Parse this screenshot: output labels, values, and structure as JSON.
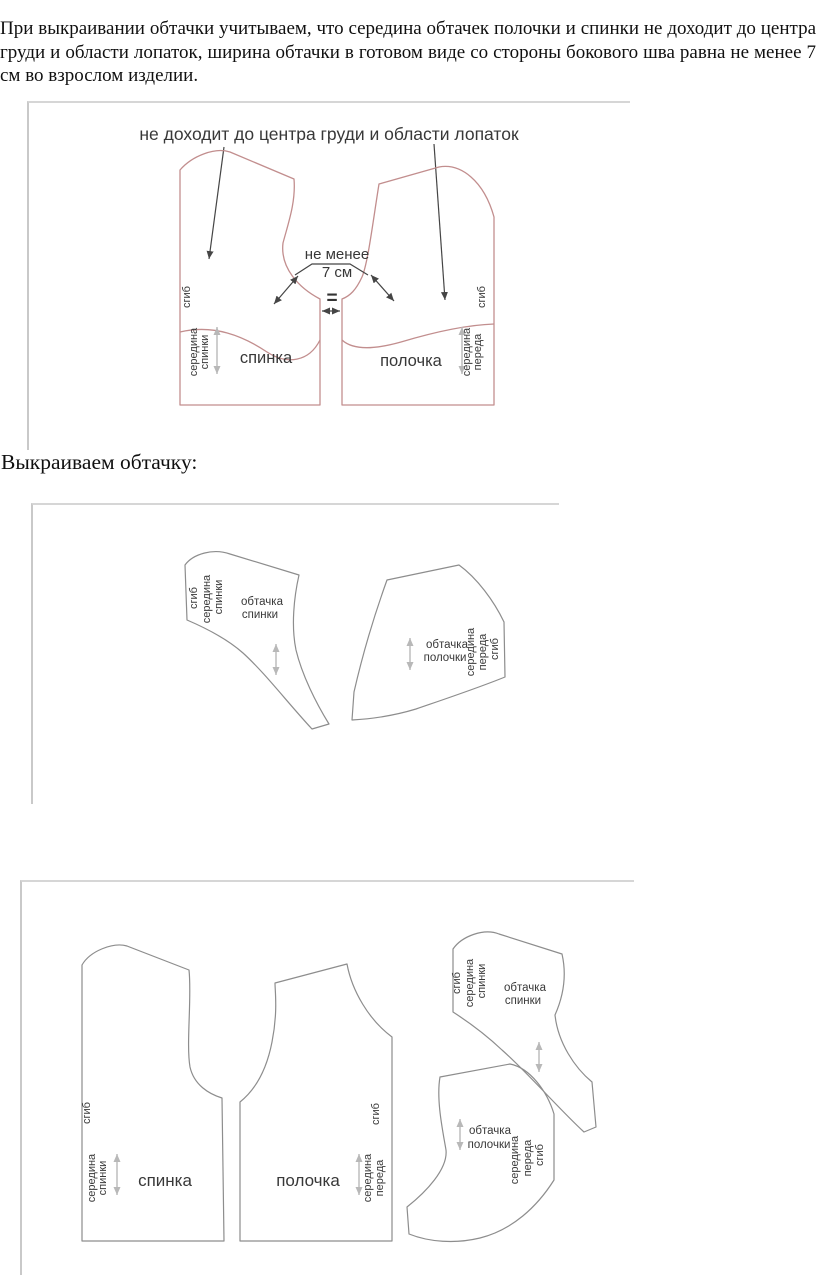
{
  "document": {
    "intro_paragraph": "При выкраивании обтачки учитываем, что середина обтачек полочки и спинки не доходит до центра груди и области лопаток, ширина обтачки в готовом виде со стороны бокового шва равна не менее 7 см во взрослом изделии.",
    "section_heading": "Выкраиваем обтачку:"
  },
  "figure1": {
    "caption": "не доходит до центра груди и области лопаток",
    "min_width_line1": "не менее",
    "min_width_line2": "7 см",
    "equals": "=",
    "back": {
      "name": "спинка",
      "fold": "сгиб",
      "center_line1": "середина",
      "center_line2": "спинки"
    },
    "front": {
      "name": "полочка",
      "fold": "сгиб",
      "center_line1": "середина",
      "center_line2": "переда"
    }
  },
  "figure2": {
    "back_facing": {
      "fold": "сгиб",
      "center_line1": "середина",
      "center_line2": "спинки",
      "name_line1": "обтачка",
      "name_line2": "спинки"
    },
    "front_facing": {
      "name_line1": "обтачка",
      "name_line2": "полочки",
      "center_line1": "середина",
      "center_line2": "переда",
      "fold": "сгиб"
    }
  },
  "figure3": {
    "back": {
      "name": "спинка",
      "fold": "сгиб",
      "center_line1": "середина",
      "center_line2": "спинки"
    },
    "front": {
      "name": "полочка",
      "fold": "сгиб",
      "center_line1": "середина",
      "center_line2": "переда"
    },
    "back_facing": {
      "fold": "сгиб",
      "center_line1": "середина",
      "center_line2": "спинки",
      "name_line1": "обтачка",
      "name_line2": "спинки"
    },
    "front_facing": {
      "name_line1": "обтачка",
      "name_line2": "полочки",
      "center_line1": "середина",
      "center_line2": "переда",
      "fold": "сгиб"
    }
  },
  "colors": {
    "pattern_outline_pink": "#c28e8e",
    "pattern_outline_gray": "#8d8d8d",
    "grain_arrow_gray": "#b8b8b8",
    "annotation_dark": "#454545",
    "figure_border": "#cccccc"
  }
}
